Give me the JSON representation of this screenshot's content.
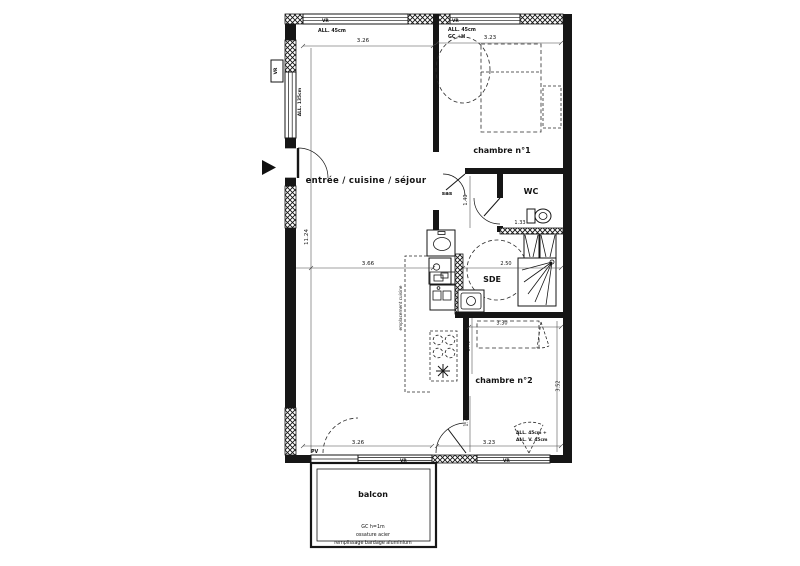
{
  "rooms": {
    "living": "entrée / cuisine / séjour",
    "bedroom1": "chambre n°1",
    "wc": "WC",
    "sas": "sas",
    "sde": "SDE",
    "bedroom2": "chambre n°2",
    "balcony": "balcon"
  },
  "dimensions": {
    "top_left": "3.26",
    "top_right": "3.23",
    "left_height": "11.24",
    "living_width": "3.66",
    "sas_height": "1.40",
    "wc_width": "1.33",
    "sde_width": "2.50",
    "bedroom2_width": "3.30",
    "bedroom2_seg1": "1.49",
    "bedroom2_seg2": "1.73",
    "bedroom2_height": "3.52",
    "bottom_left": "3.26",
    "bottom_right": "3.23"
  },
  "openings": {
    "vr_top_left": "VR",
    "vr_top_right": "VR",
    "vr_left": "VR",
    "vr_bottom_center": "VR",
    "vr_bottom_right": "VR",
    "pv_bottom": "PV",
    "all_top_left": "ALL. 45cm",
    "all_top_right_1": "ALL. 45cm",
    "all_top_right_2": "GC +H",
    "all_left": "ALL. 135cm",
    "all_bottom_1": "ALL. 45cm +",
    "all_bottom_2": "ALL. V. 45cm"
  },
  "kitchen": {
    "zone_label": "emplacement cuisine"
  },
  "balcony_note": {
    "line1": "GC h=1m",
    "line2": "ossature acier",
    "line3": "remplissage bardage aluminium"
  },
  "colors": {
    "ink": "#161616",
    "paper": "#ffffff"
  }
}
